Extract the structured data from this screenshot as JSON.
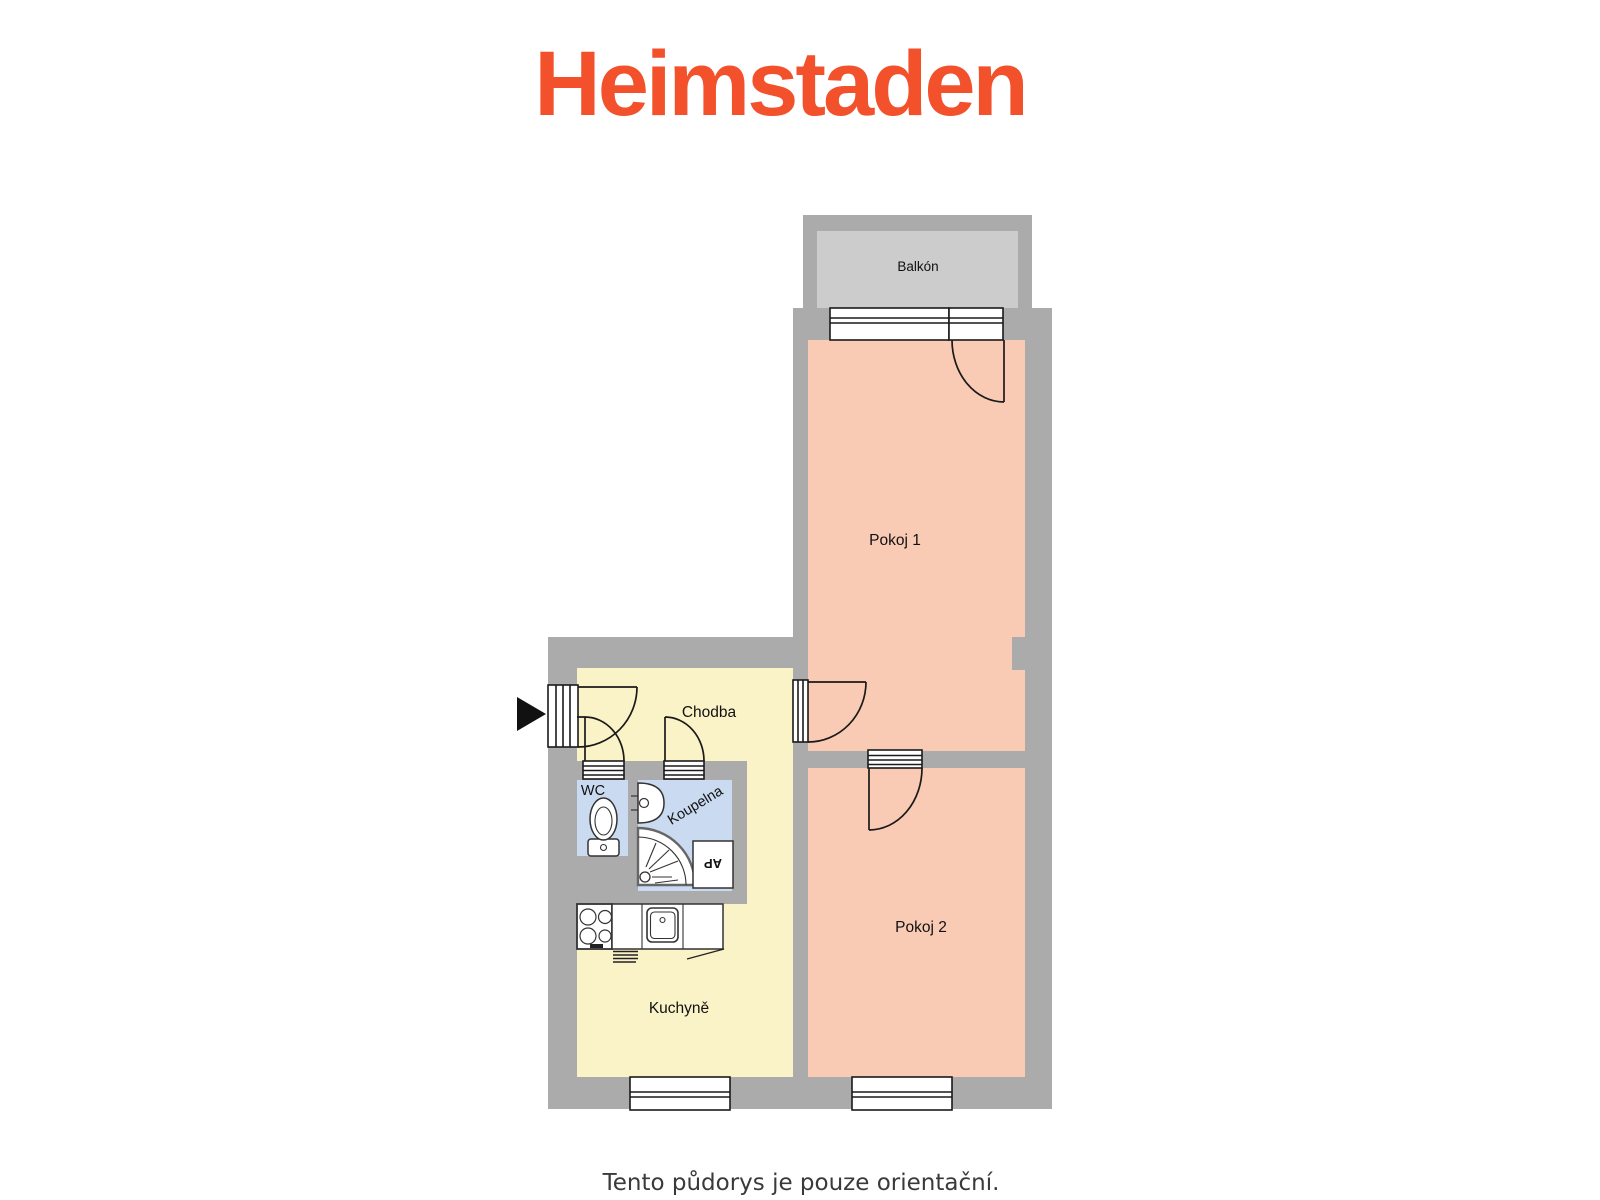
{
  "logo": {
    "text": "Heimstaden",
    "color": "#F2512B"
  },
  "floor_plan": {
    "rooms": {
      "balkon": {
        "label": "Balkón"
      },
      "pokoj1": {
        "label": "Pokoj 1"
      },
      "pokoj2": {
        "label": "Pokoj 2"
      },
      "chodba": {
        "label": "Chodba"
      },
      "wc": {
        "label": "WC"
      },
      "koupelna": {
        "label": "Koupelna"
      },
      "kuchyne": {
        "label": "Kuchyně"
      },
      "pracka": {
        "label": "AP"
      }
    },
    "colors": {
      "wall": "#ABABAB",
      "balcony_floor": "#CCCCCC",
      "room_pink": "#FACBB4",
      "room_yellow": "#FBF3C8",
      "room_blue": "#C9DAF1",
      "line": "#1A1A1A",
      "text": "#111111"
    }
  },
  "footer": {
    "disclaimer": "Tento půdorys je pouze orientační.",
    "color": "#3A3A3A"
  }
}
